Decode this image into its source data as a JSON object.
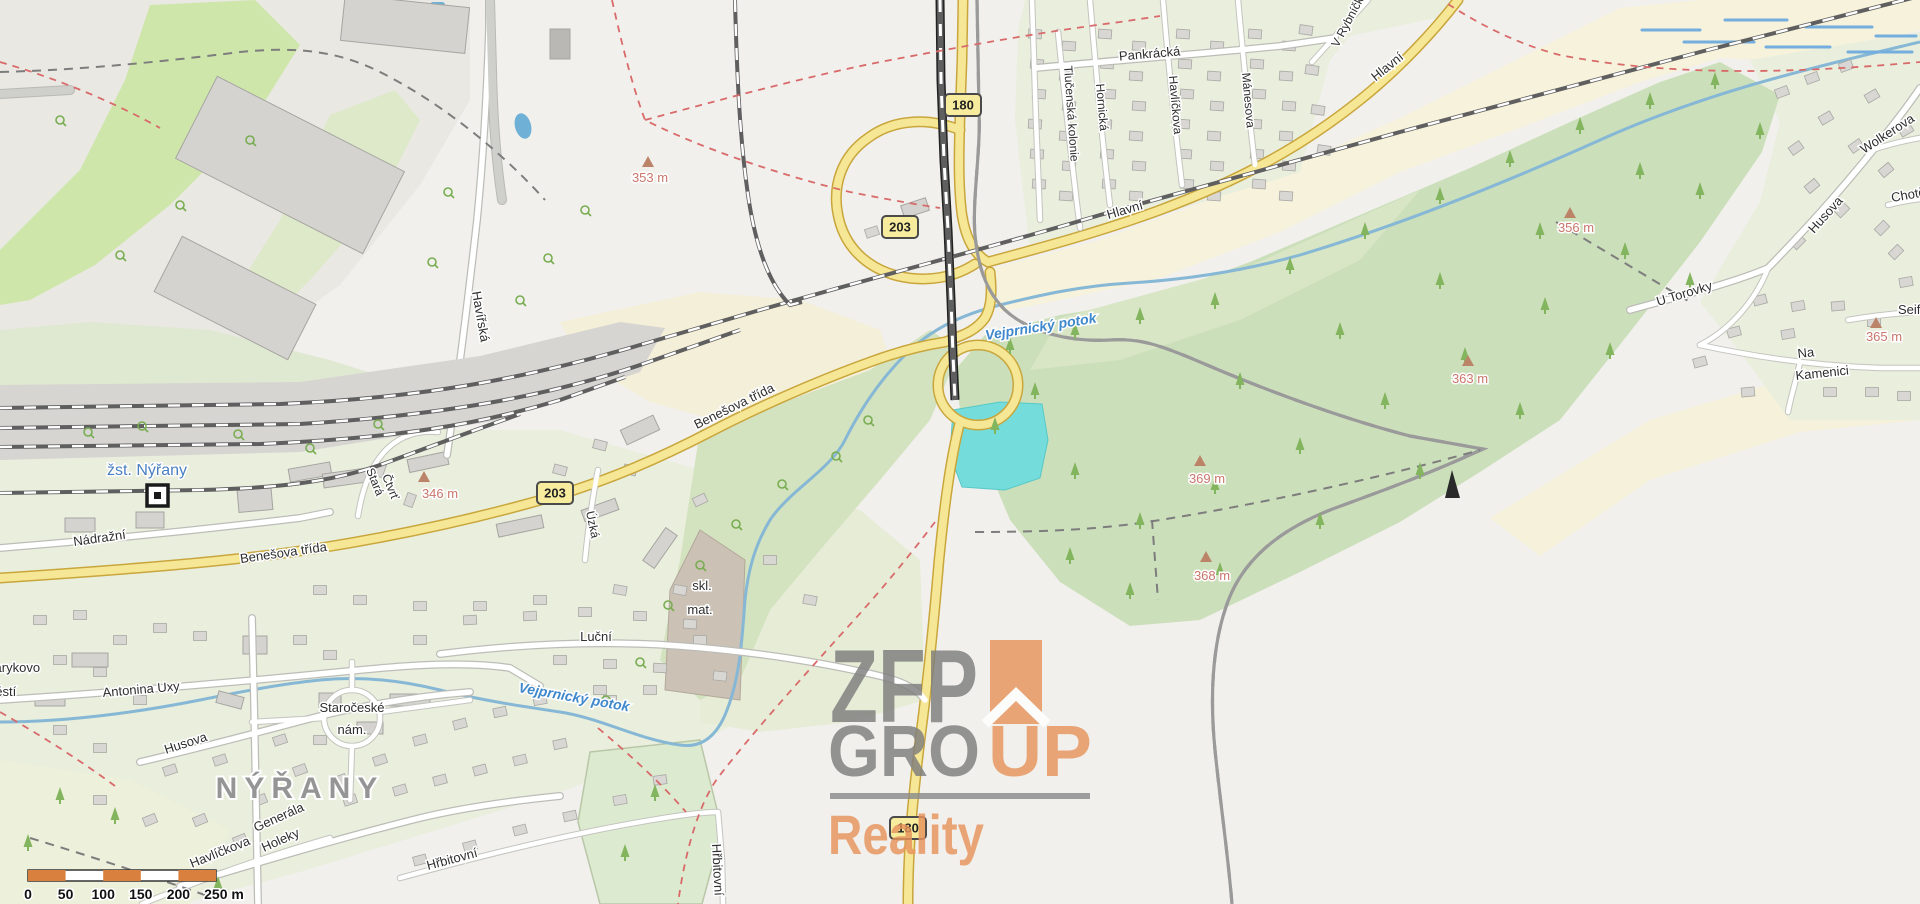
{
  "place_labels": {
    "town": "NÝŘANY",
    "station": "žst. Nýřany",
    "square_line1": "Masarykovo",
    "square_line2": "náměstí",
    "old_square_line1": "Staročeské",
    "old_square_line2": "nám.",
    "storage_line1": "skl.",
    "storage_line2": "mat."
  },
  "street_labels": [
    "Pankrácká",
    "Tlučenská kolonie",
    "Hornická",
    "Havlíčkova",
    "Mánesova",
    "V Rybníčkách",
    "Hlavní",
    "Hlavní",
    "Wolkerova",
    "Chotěšovská",
    "Husova",
    "U Torovky",
    "Na",
    "Kamenici",
    "Seifertova",
    "Havířská",
    "Benešova třída",
    "Benešova třída",
    "Nádražní",
    "Stará",
    "Čtvrť",
    "Úzká",
    "Luční",
    "Antonina Uxy",
    "Husova",
    "Generála",
    "Holeky",
    "Havlíčkova",
    "Hřbitovní",
    "Hřbitovní"
  ],
  "water_labels": [
    "Vejprnický potok",
    "Vejprnický potok"
  ],
  "elevation_labels": [
    "353 m",
    "346 m",
    "356 m",
    "363 m",
    "365 m",
    "369 m",
    "368 m"
  ],
  "road_shields": [
    "180",
    "203",
    "203",
    "180"
  ],
  "watermark": {
    "zfp": "ZFP",
    "gro": "GRO",
    "up": "UP",
    "reality": "Reality"
  },
  "scale_bar": {
    "ticks": [
      "0",
      "50",
      "100",
      "150",
      "200",
      "250 m"
    ]
  },
  "colors": {
    "road_primary": "#f5e796",
    "road_primary_casing": "#c9a63c",
    "forest": "#ccdfbb",
    "residential": "#e9eedd",
    "farmland": "#f6f2dc",
    "water_stream": "#86b8d6",
    "pond": "#74dcdb",
    "boundary": "#c95fc9",
    "watermark_gray": "#7e7e7e",
    "watermark_orange": "#e8945c",
    "scale_orange": "#d9803f"
  }
}
